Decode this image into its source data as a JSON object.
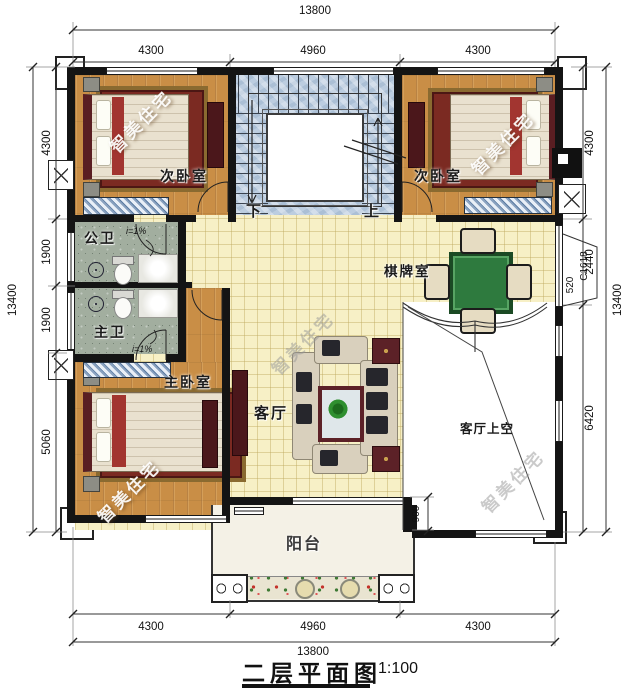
{
  "title": {
    "text": "二层平面图",
    "scale": "1:100"
  },
  "watermark_text": "智美住宅",
  "dims": {
    "top_total": "13800",
    "top_segments": [
      "4300",
      "4960",
      "4300"
    ],
    "bottom_total": "13800",
    "bottom_segments": [
      "4300",
      "4960",
      "4300"
    ],
    "left_total": "13400",
    "left_segments": [
      "4300",
      "1900",
      "1900",
      "5060"
    ],
    "right_total": "13400",
    "right_segments": [
      "4300",
      "2440",
      "6420"
    ],
    "balcony_depth": "900"
  },
  "rooms": {
    "bedroom_left": "次卧室",
    "bedroom_right": "次卧室",
    "master_bedroom": "主卧室",
    "public_bath": "公卫",
    "master_bath": "主卫",
    "living": "客厅",
    "chess": "棋牌室",
    "living_void": "客厅上空",
    "balcony": "阳台"
  },
  "stairs": {
    "down": "下",
    "up": "上"
  },
  "annotations": {
    "slope_public": "i=1%",
    "slope_master": "i=1%",
    "window_code": "C1618",
    "window_width": "520"
  },
  "colors": {
    "wall": "#141414",
    "wood_floor": "#c98e46",
    "tile_floor": "#f7f0c6",
    "stair_floor": "#bccde0",
    "bath_floor": "#a2ae9f",
    "balcony_stone": "#d9d3c2",
    "mahjong_table": "#2e7a3e",
    "cabinet_red": "#4b171b"
  }
}
